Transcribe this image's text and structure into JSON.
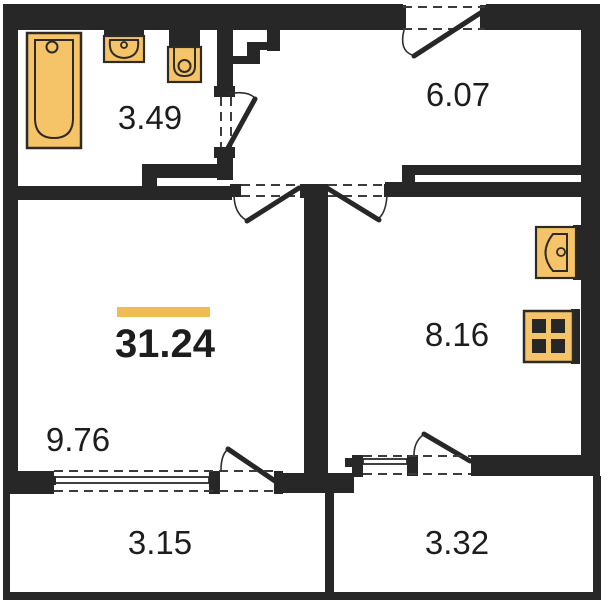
{
  "total_area": {
    "value": "31.24"
  },
  "rooms": {
    "bathroom": {
      "area": "3.49"
    },
    "hallway": {
      "area": "6.07"
    },
    "living_room": {
      "area": "9.76"
    },
    "kitchen": {
      "area": "8.16"
    },
    "balcony_left": {
      "area": "3.15"
    },
    "balcony_right": {
      "area": "3.32"
    }
  },
  "fixtures": [
    "bathtub-icon",
    "washbasin-icon",
    "toilet-icon",
    "kitchen-sink-icon",
    "stove-icon"
  ],
  "doors": [
    "entry-door",
    "bathroom-door",
    "living-room-door",
    "kitchen-door",
    "living-balcony-door",
    "kitchen-balcony-door"
  ],
  "windows": [
    "living-room-window",
    "kitchen-window"
  ],
  "colors": {
    "wall": "#272727",
    "fixture_fill": "#f5c468",
    "fixture_stroke": "#2e2a26",
    "accent_bar": "#f2bc55",
    "background": "#ffffff",
    "text": "#1d1d1d"
  }
}
